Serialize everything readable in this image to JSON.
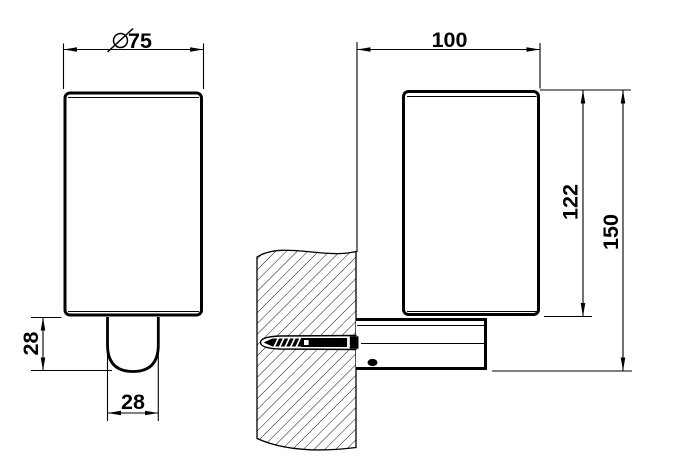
{
  "colors": {
    "line": "#000000",
    "background": "#ffffff"
  },
  "views": {
    "front_view": {
      "width_dim": {
        "symbol": "⌀",
        "value": "75"
      },
      "holder_height_dim": {
        "value": "28"
      },
      "holder_width_dim": {
        "value": "28"
      }
    },
    "side_view": {
      "depth_dim": {
        "value": "100"
      },
      "body_height_dim": {
        "value": "122"
      },
      "total_height_dim": {
        "value": "150"
      }
    }
  }
}
